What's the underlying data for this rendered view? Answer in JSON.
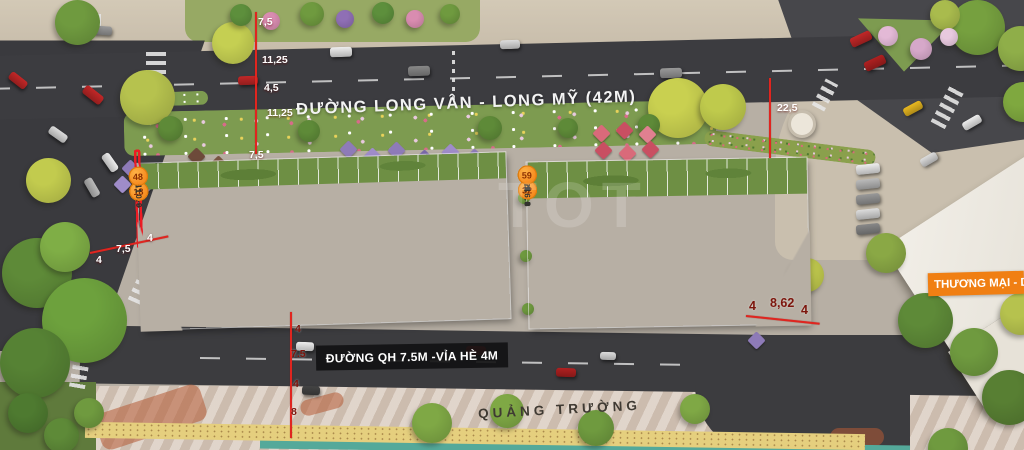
{
  "annotations": {
    "main_road_label": "ĐƯỜNG LONG VÂN - LONG MỸ (42M)",
    "qh_road_label": "ĐƯỜNG QH 7.5M -VỈA HÈ 4M",
    "plaza_label": "QUẢNG TRƯỜNG",
    "commercial_label": "THƯƠNG MẠI - DỊ",
    "watermark": "TOT"
  },
  "dimension_labels": [
    {
      "text": "7,5",
      "x": 258,
      "y": 16,
      "theme": "light"
    },
    {
      "text": "11,25",
      "x": 262,
      "y": 54,
      "theme": "light"
    },
    {
      "text": "4,5",
      "x": 264,
      "y": 82,
      "theme": "light"
    },
    {
      "text": "11,25",
      "x": 267,
      "y": 107,
      "theme": "light"
    },
    {
      "text": "7,5",
      "x": 249,
      "y": 149,
      "theme": "light"
    },
    {
      "text": "22,5",
      "x": 777,
      "y": 102,
      "theme": "light"
    },
    {
      "text": "4",
      "x": 96,
      "y": 254,
      "theme": "light"
    },
    {
      "text": "7,5",
      "x": 116,
      "y": 243,
      "theme": "light"
    },
    {
      "text": "4",
      "x": 147,
      "y": 232,
      "theme": "light"
    },
    {
      "text": "4",
      "x": 295,
      "y": 323,
      "theme": "dark"
    },
    {
      "text": "7.5",
      "x": 291,
      "y": 348,
      "theme": "dark"
    },
    {
      "text": "4",
      "x": 293,
      "y": 378,
      "theme": "dark"
    },
    {
      "text": "8",
      "x": 291,
      "y": 406,
      "theme": "dark"
    },
    {
      "text": "4",
      "x": 749,
      "y": 299,
      "theme": "dark",
      "big": true
    },
    {
      "text": "8,62",
      "x": 770,
      "y": 296,
      "theme": "dark",
      "big": true
    },
    {
      "text": "4",
      "x": 801,
      "y": 303,
      "theme": "dark",
      "big": true
    }
  ],
  "blocks": {
    "a_top": [
      {
        "no": "01",
        "area": "138.0",
        "wide": 1.6
      },
      {
        "no": "02",
        "area": "96.5",
        "hl": true
      },
      {
        "no": "03",
        "area": "97.0"
      },
      {
        "no": "04",
        "area": "97.4",
        "hl": true
      },
      {
        "no": "05",
        "area": "98.0"
      },
      {
        "no": "06",
        "area": "98.5"
      },
      {
        "no": "07",
        "area": "99.2",
        "hl": true
      },
      {
        "no": "08",
        "area": "99.6",
        "hl": true
      },
      {
        "no": "09",
        "area": "100.6",
        "hl": true
      },
      {
        "no": "10",
        "area": "101.5"
      },
      {
        "no": "11",
        "area": "102.6"
      },
      {
        "no": "12",
        "area": "103.6",
        "hl": true
      },
      {
        "no": "13",
        "area": "105.4",
        "hl": true
      },
      {
        "no": "14",
        "area": "106.4"
      },
      {
        "no": "15",
        "area": "108.3",
        "hl": true
      },
      {
        "no": "16",
        "area": "109.5",
        "hl": true
      },
      {
        "no": "17",
        "area": "110.0"
      },
      {
        "no": "18",
        "area": "110.0"
      }
    ],
    "a_bottom": [
      {
        "no": "33",
        "area": "167.1",
        "wide": 2.0
      },
      {
        "no": "34",
        "area": "92.5"
      },
      {
        "no": "35",
        "area": "92.5"
      },
      {
        "no": "36",
        "area": "92.5"
      },
      {
        "no": "37",
        "area": "92.5"
      },
      {
        "no": "38",
        "area": "92.5"
      },
      {
        "no": "39",
        "area": "92.5"
      },
      {
        "no": "40",
        "area": "92.5"
      },
      {
        "no": "41",
        "area": "92.5"
      },
      {
        "no": "42",
        "area": "92.5"
      },
      {
        "no": "43",
        "area": "92.5"
      },
      {
        "no": "44",
        "area": "92.6"
      },
      {
        "no": "45",
        "area": "93.1"
      },
      {
        "no": "46",
        "area": "93.6"
      },
      {
        "no": "47",
        "area": "94.8"
      },
      {
        "no": "48",
        "area": "95.6"
      }
    ],
    "b_top": [
      {
        "no": "19",
        "area": "110.0"
      },
      {
        "no": "20",
        "area": "110.0"
      },
      {
        "no": "21",
        "area": "110.0"
      },
      {
        "no": "22",
        "area": "110.0"
      },
      {
        "no": "23",
        "area": "110.0"
      },
      {
        "no": "24",
        "area": "110.0"
      },
      {
        "no": "25",
        "area": "110.0"
      },
      {
        "no": "26",
        "area": "110.0"
      },
      {
        "no": "27",
        "area": "110.0"
      },
      {
        "no": "28",
        "area": "110.0"
      },
      {
        "no": "29",
        "area": "110.0"
      },
      {
        "no": "30",
        "area": "110.0"
      },
      {
        "no": "31",
        "area": "112.1"
      },
      {
        "no": "32",
        "area": "216.6",
        "wide": 1.8
      }
    ],
    "b_bottom": [
      {
        "no": "49",
        "area": "98.6"
      },
      {
        "no": "50",
        "area": "100.4"
      },
      {
        "no": "51",
        "area": "102.2"
      },
      {
        "no": "52",
        "area": "104.3"
      },
      {
        "no": "53",
        "area": "106.5"
      },
      {
        "no": "54",
        "area": "108.6"
      },
      {
        "no": "55",
        "area": "111.5"
      },
      {
        "no": "56",
        "area": "114.3"
      },
      {
        "no": "57",
        "area": "117.3"
      },
      {
        "no": "58",
        "area": "120.4"
      },
      {
        "no": "59",
        "area": "189.6",
        "wide": 1.9
      }
    ]
  },
  "colors": {
    "badge_orange": "#F68B1F",
    "highlight_red": "#EC1C24",
    "dimension_red": "#E0251F",
    "commercial_banner_orange": "#F07F13",
    "garden_green": "#6E8F44",
    "water_teal": "#54A99A"
  }
}
